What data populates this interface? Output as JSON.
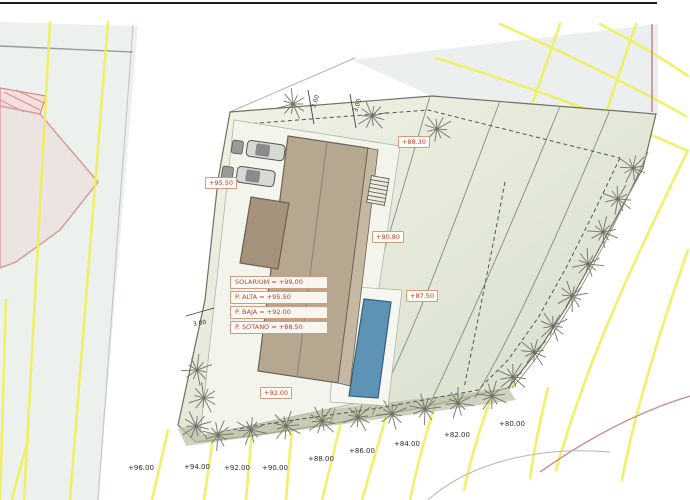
{
  "drawing": {
    "kind": "architectural site plan",
    "levels_table": {
      "rows": [
        {
          "label": "SOLARIUM = +99.00"
        },
        {
          "label": "P. ALTA = +95.50"
        },
        {
          "label": "P. BAJA = +92.00"
        },
        {
          "label": "P. SOTANO = +88.50"
        }
      ]
    },
    "spot_elevations": [
      {
        "text": "+95.50",
        "x": 205,
        "y": 177
      },
      {
        "text": "+88.30",
        "x": 398,
        "y": 136
      },
      {
        "text": "+90.80",
        "x": 372,
        "y": 231
      },
      {
        "text": "+87.50",
        "x": 406,
        "y": 290
      },
      {
        "text": "+92.00",
        "x": 260,
        "y": 387
      }
    ],
    "contour_labels": [
      {
        "text": "+96.00",
        "x": 128,
        "y": 464
      },
      {
        "text": "+94.00",
        "x": 184,
        "y": 463
      },
      {
        "text": "+92.00",
        "x": 224,
        "y": 464
      },
      {
        "text": "+90.00",
        "x": 262,
        "y": 464
      },
      {
        "text": "+88.00",
        "x": 308,
        "y": 455
      },
      {
        "text": "+86.00",
        "x": 349,
        "y": 447
      },
      {
        "text": "+84.00",
        "x": 394,
        "y": 440
      },
      {
        "text": "+82.00",
        "x": 444,
        "y": 431
      },
      {
        "text": "+80.00",
        "x": 499,
        "y": 420
      }
    ],
    "dimensions": [
      {
        "text": "3.00",
        "x": 309,
        "y": 98,
        "rot": -72
      },
      {
        "text": "3.00",
        "x": 351,
        "y": 102,
        "rot": -72
      },
      {
        "text": "3.00",
        "x": 193,
        "y": 320,
        "rot": -10
      }
    ],
    "colors": {
      "contour_yellow": "#f0ef5a",
      "roof_tan": "#b6a791",
      "roof_dark": "#a5927b",
      "pool_blue": "#5e93b5",
      "label_red": "#c23b2e",
      "label_border": "#d49a7e",
      "plot_green": "#e3e9d6",
      "tree_gray": "#6b6b62",
      "neighbor_pink": "#d89c9c"
    }
  }
}
